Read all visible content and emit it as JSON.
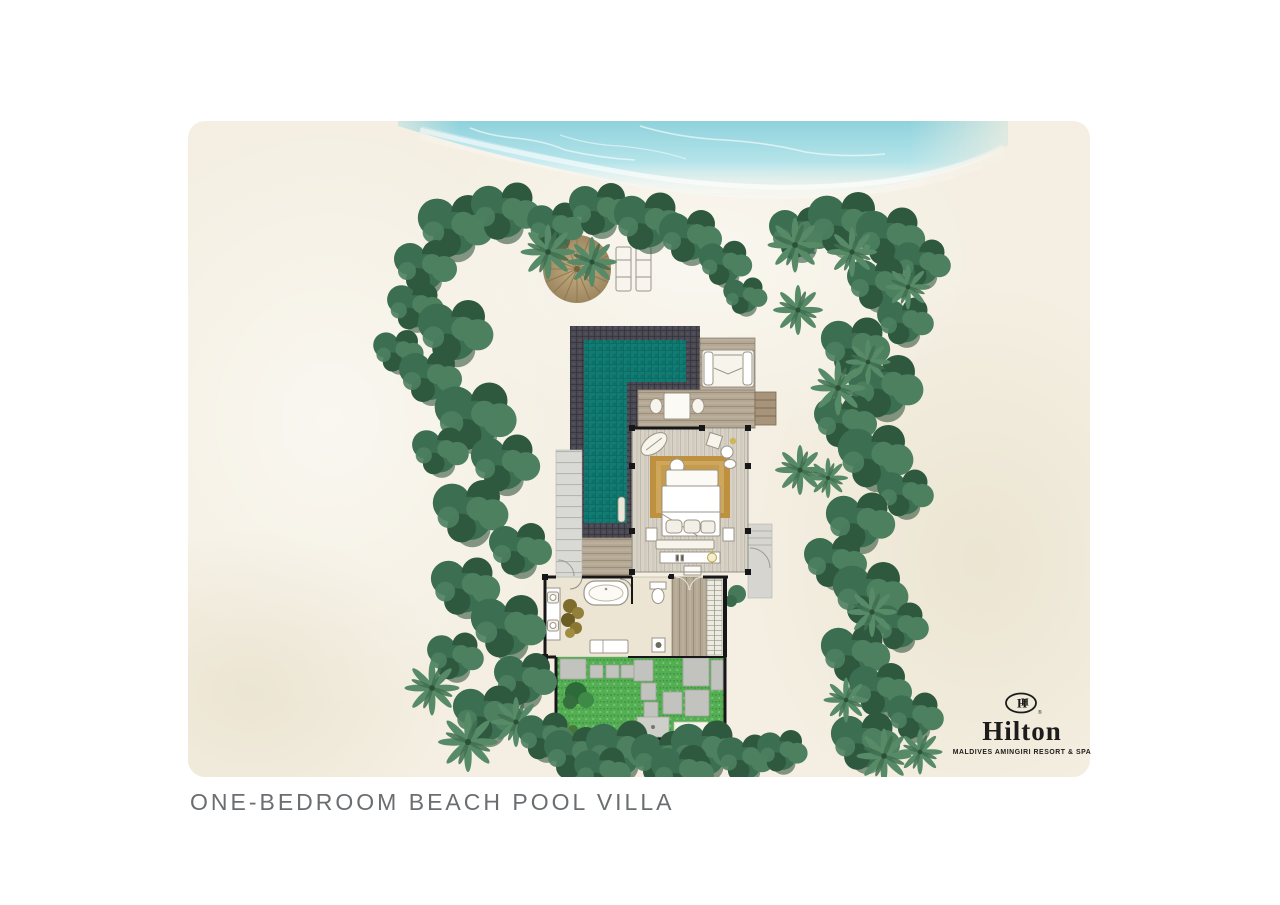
{
  "caption": {
    "text": "ONE-BEDROOM BEACH POOL VILLA"
  },
  "brand": {
    "name": "Hilton",
    "subtitle": "MALDIVES AMINGIRI RESORT & SPA",
    "registered_mark": "®",
    "emblem": "hilton-double-h-monogram",
    "monogram_letters": "H"
  },
  "features": [
    "ocean",
    "beach-sand",
    "tropical-trees",
    "palm-trees",
    "beach-umbrella",
    "sun-loungers",
    "private-pool",
    "pool-ladder",
    "wood-deck",
    "daybed",
    "outdoor-dining-table",
    "side-steps",
    "bedroom",
    "king-bed",
    "area-rug",
    "bed-bench",
    "tv-console",
    "lounge-chair",
    "bathroom",
    "bathtub",
    "double-vanity",
    "toilet",
    "indoor-plant",
    "wardrobe-corridor",
    "closet",
    "garden-courtyard",
    "stepping-stones",
    "outdoor-shower",
    "entry-steps",
    "walkway"
  ],
  "colors": {
    "page-bg": "#ffffff",
    "sand": "#f4efe2",
    "sand-shade": "#e9e2cf",
    "ocean": "#96d6e0",
    "ocean-light": "#cdecf1",
    "foliage-dark": "#2e593f",
    "foliage": "#3c6e51",
    "foliage-light": "#4d805f",
    "palm": "#578a67",
    "pool": "#117c73",
    "pool-tile": "#0b6a61",
    "pool-border": "#4a4852",
    "deck": "#b4a794",
    "deck-seam": "#93866f",
    "floor": "#d7d1c6",
    "floor-seam": "#b9b2a3",
    "bath-floor": "#ece5d4",
    "grass": "#55ae53",
    "grass-dark": "#3f9a41",
    "stone": "#c2c3be",
    "stone-line": "#a3a49e",
    "wall": "#17171a",
    "umbrella": "#b29468",
    "umbrella-line": "#8a7452",
    "furniture": "#f7f4ec",
    "furniture-line": "#9b9488",
    "rug": "#bd9140",
    "rug-inner": "#cfa75c",
    "walkway": "#d9d9d5",
    "walkway-line": "#b6b6b0",
    "caption-text": "#6a6e71",
    "brand-text": "#1c1c1c"
  }
}
